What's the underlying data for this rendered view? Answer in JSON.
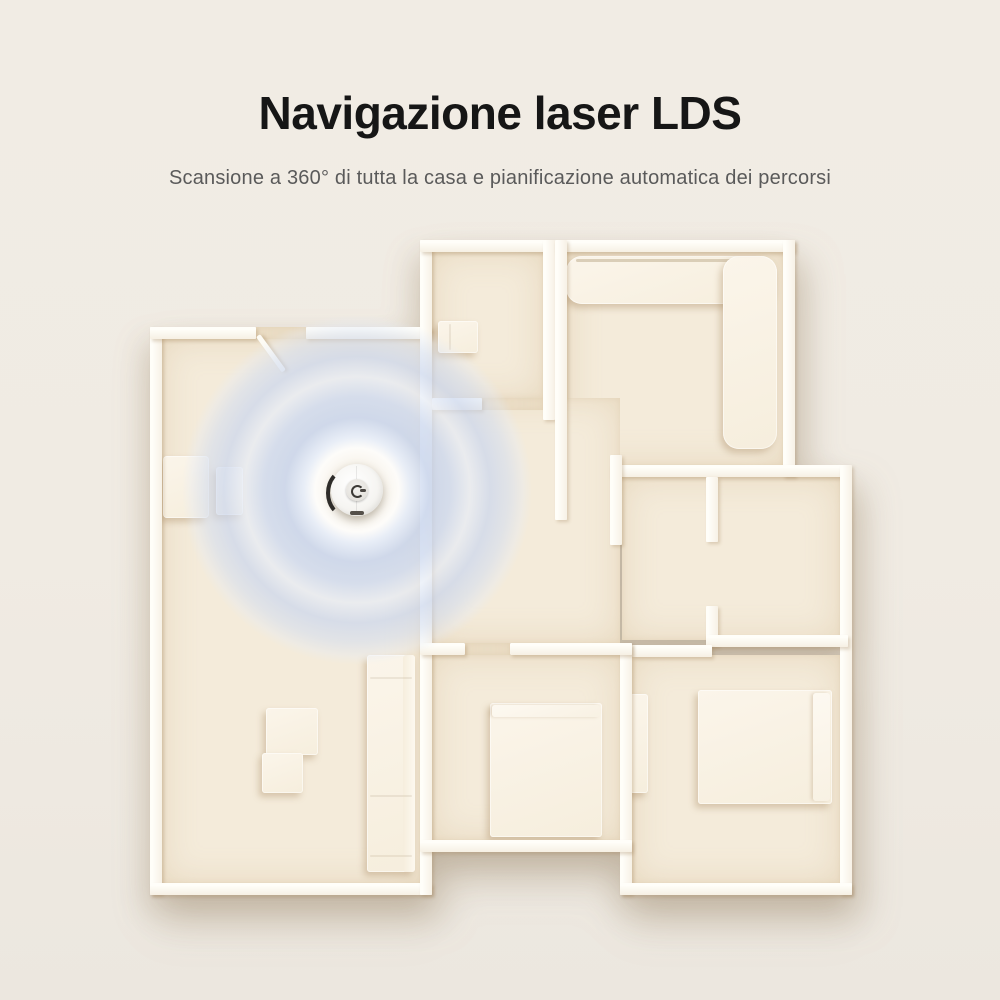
{
  "header": {
    "title": "Navigazione laser LDS",
    "subtitle": "Scansione a 360° di tutta la casa e pianificazione automatica dei percorsi",
    "title_color": "#161616",
    "subtitle_color": "#5a5a5a"
  },
  "page": {
    "background_color": "#f0ebe3"
  },
  "floorplan": {
    "wall_color": "#fdfbf4",
    "floor_color": "#f4ebda",
    "scan_wave_color": "#c7d4ed",
    "robot_body_color": "#f6f5f2",
    "robot_bumper_color": "#2e2c29",
    "elements": [
      "robot-vacuum",
      "lidar-scan-waves",
      "charging-dock",
      "side-table",
      "living-room-sofa",
      "coffee-table",
      "bathroom-fixture",
      "l-shaped-sofa",
      "wardrobe",
      "double-bed",
      "single-bed",
      "door-leaf"
    ]
  }
}
